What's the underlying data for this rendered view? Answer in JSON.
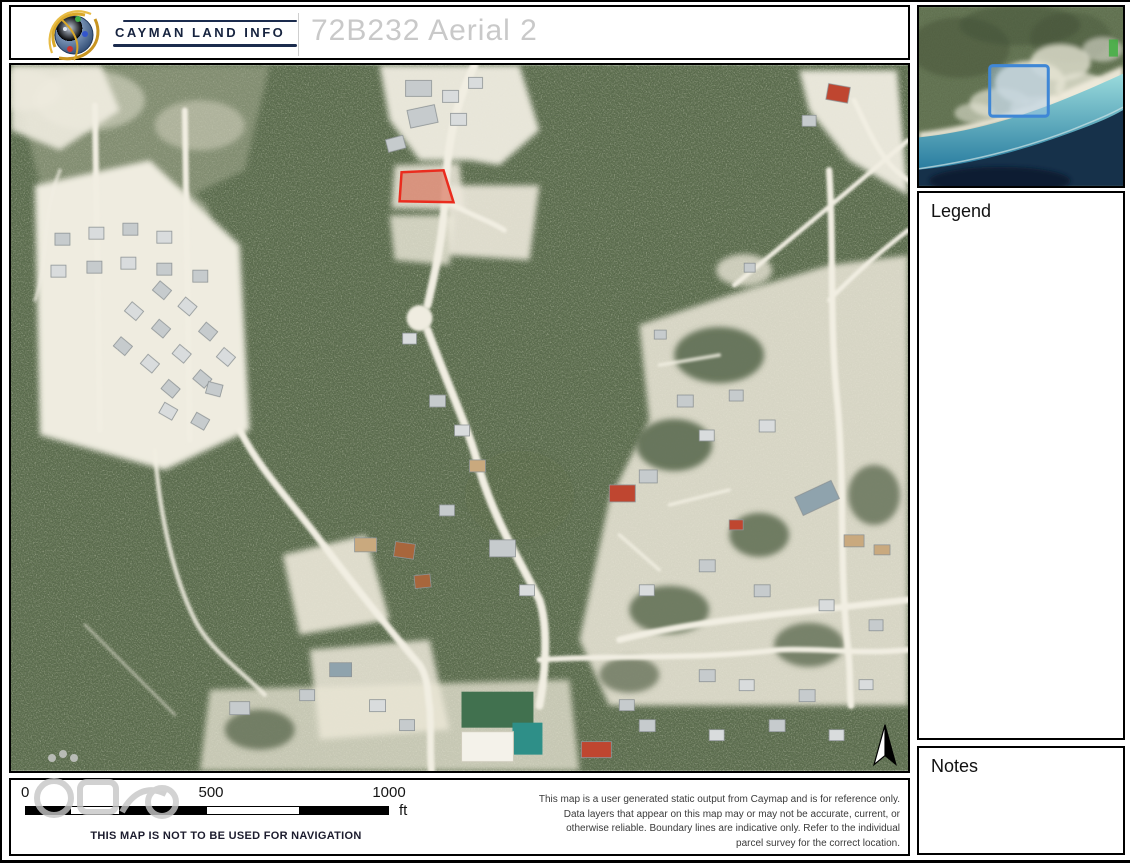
{
  "header": {
    "brand": "CAYMAN LAND INFO",
    "title": "72B232 Aerial 2"
  },
  "panels": {
    "legend_title": "Legend",
    "notes_title": "Notes"
  },
  "footer": {
    "scale_bar": {
      "tick_start": "0",
      "tick_mid": "500",
      "tick_end": "1000",
      "unit": "ft"
    },
    "navigation_warning": "THIS MAP IS NOT TO BE USED FOR NAVIGATION",
    "disclaimer": "This map is a user generated static output from Caymap and is for reference only. Data layers that appear on this map may or may not be accurate, current, or otherwise reliable. Boundary lines are indicative only. Refer to the individual parcel survey for the correct location."
  },
  "map": {
    "highlighted_parcel_color": "#ea2c1e",
    "extent_indicator_color": "#3f87d6"
  }
}
